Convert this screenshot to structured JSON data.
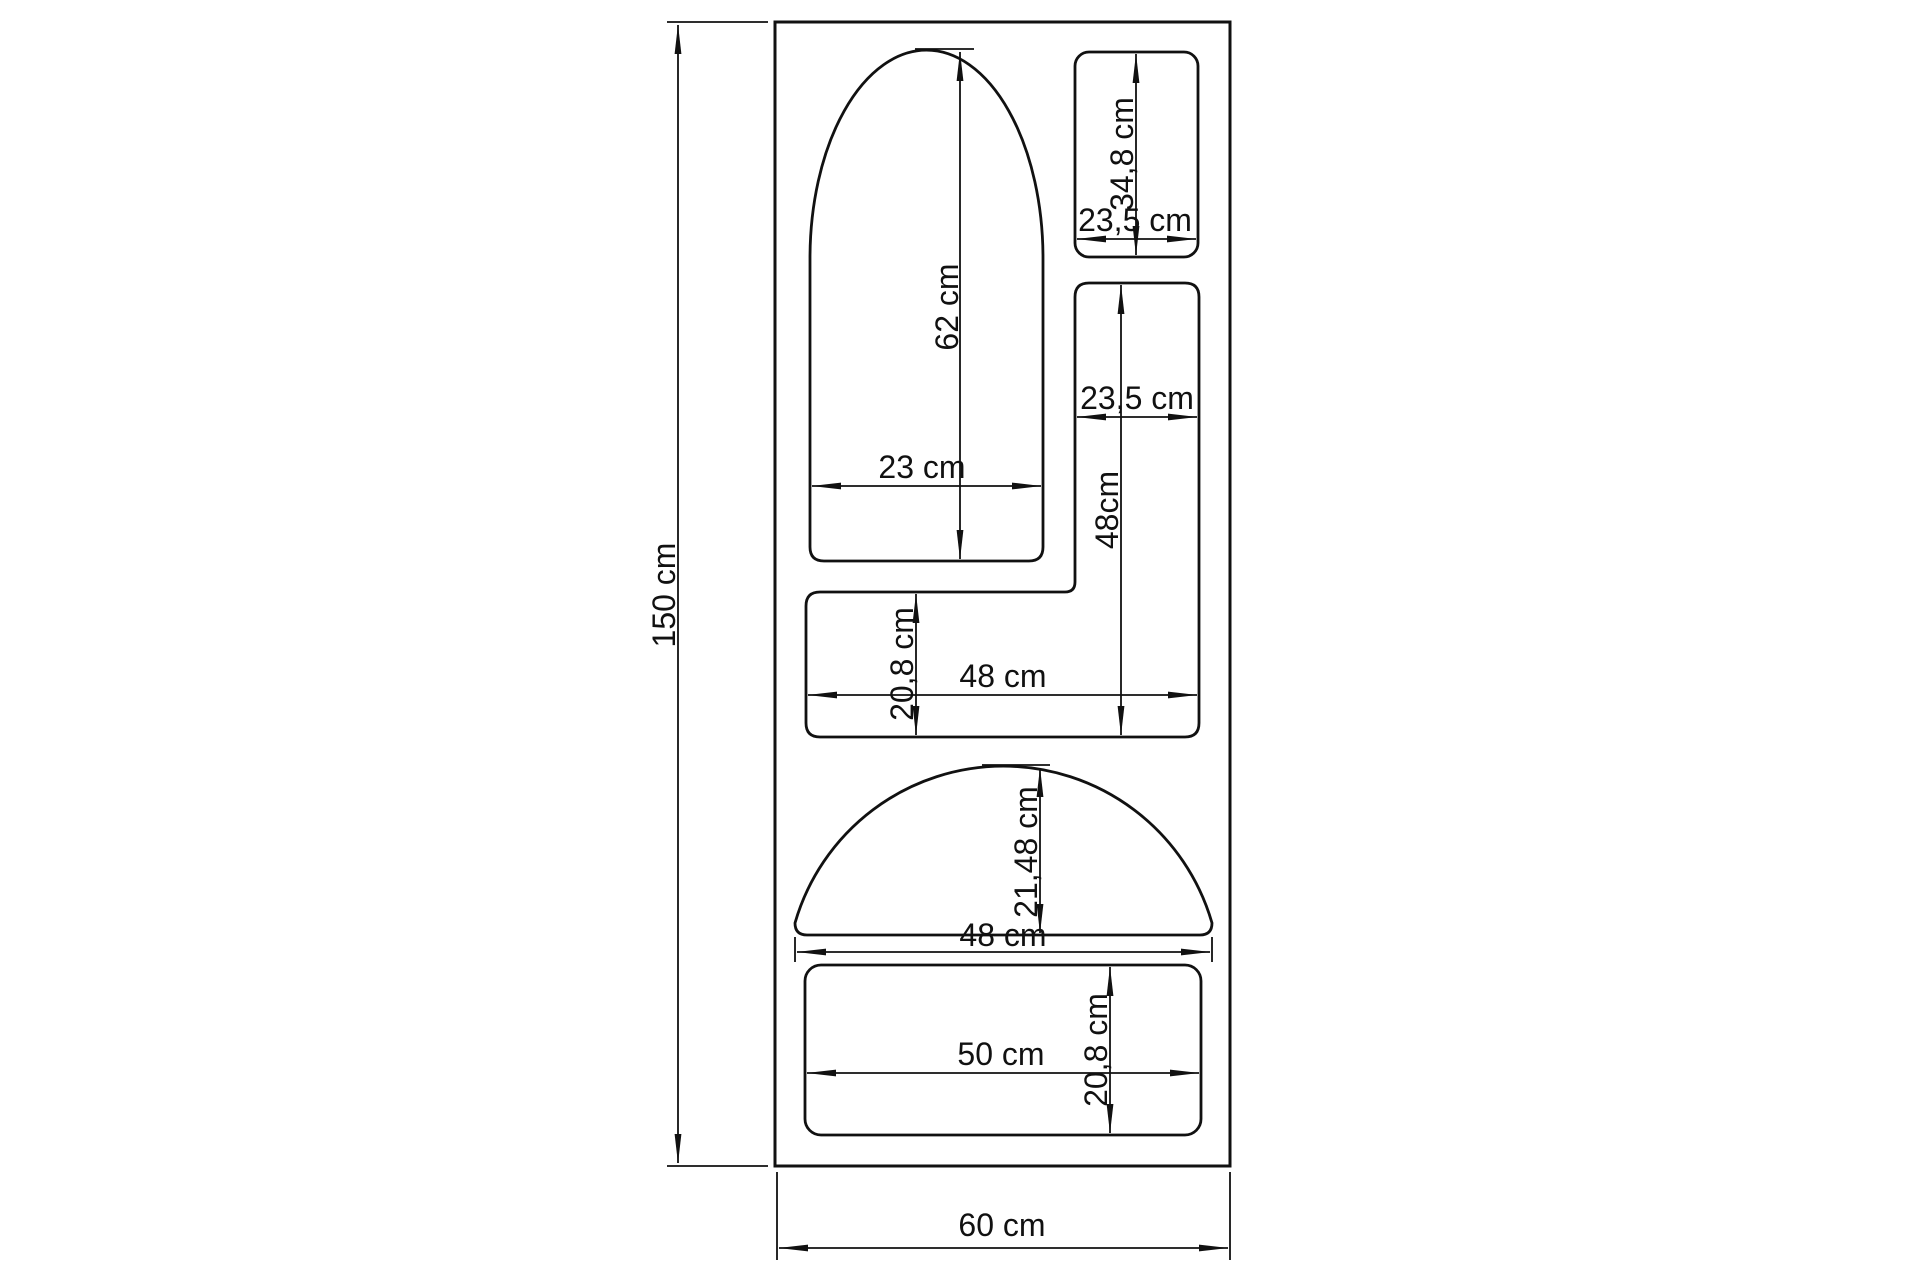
{
  "drawing": {
    "unit": "cm",
    "colors": {
      "line": "#111111",
      "background": "#ffffff"
    },
    "overall": {
      "height": {
        "label": "150 cm",
        "value": 150
      },
      "width": {
        "label": "60 cm",
        "value": 60
      }
    },
    "compartments": {
      "arch": {
        "name": "arched niche",
        "width_label": "23 cm",
        "height_label": "62 cm",
        "width_value": 23,
        "height_value": 62
      },
      "top_right": {
        "name": "small top niche",
        "width_label": "23,5 cm",
        "height_label": "34,8 cm",
        "width_value": 23.5,
        "height_value": 34.8
      },
      "right_column": {
        "name": "tall right niche",
        "width_label": "23,5 cm",
        "height_label": "48cm",
        "width_value": 23.5,
        "height_value": 48
      },
      "left_bar": {
        "name": "wide middle niche",
        "width_label": "48 cm",
        "height_label": "20,8 cm",
        "width_value": 48,
        "height_value": 20.8
      },
      "dome": {
        "name": "half-round niche",
        "width_label": "48 cm",
        "height_label": "21,48 cm",
        "width_value": 48,
        "height_value": 21.48
      },
      "bottom": {
        "name": "bottom niche",
        "width_label": "50 cm",
        "height_label": "20,8 cm",
        "width_value": 50,
        "height_value": 20.8
      }
    }
  }
}
